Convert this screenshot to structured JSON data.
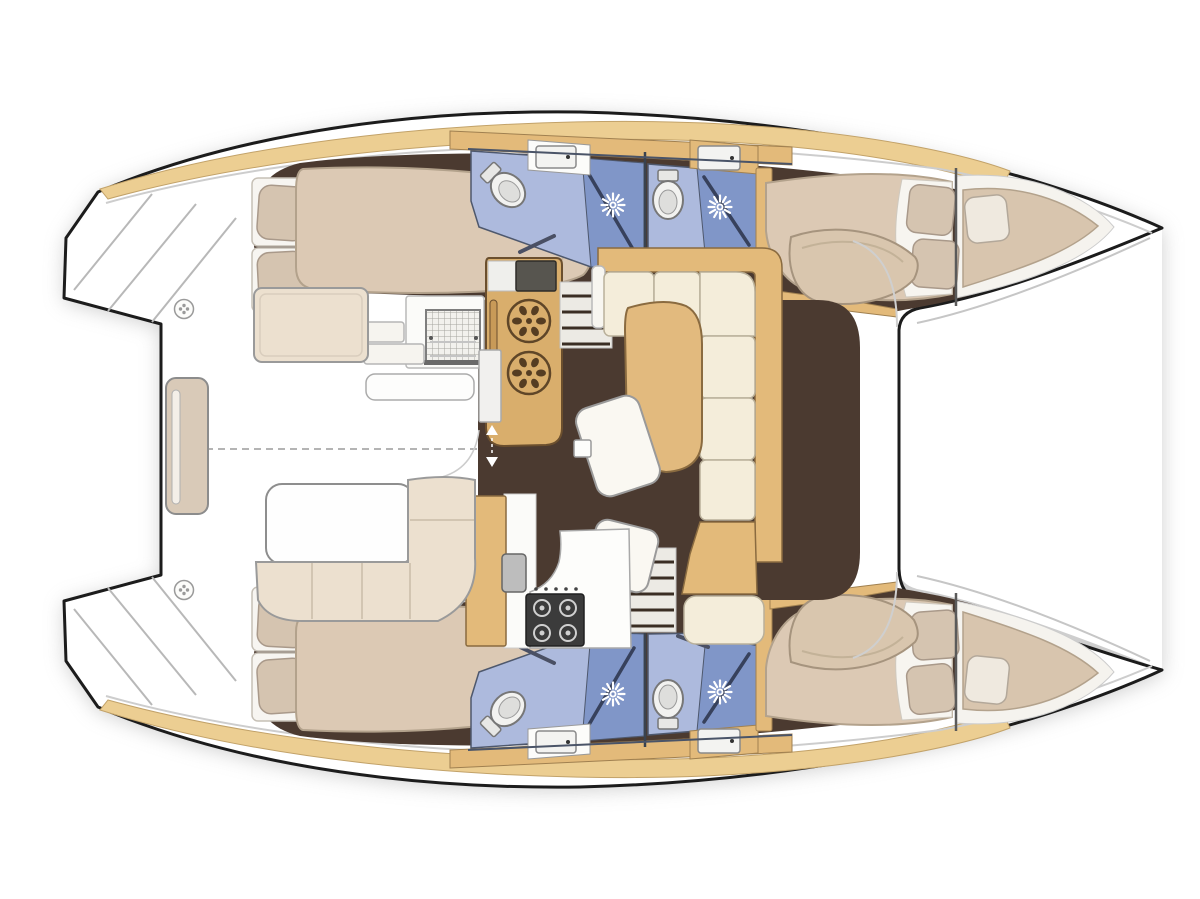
{
  "diagram": {
    "title": "Catamaran yacht floor plan",
    "type": "boat-deck-and-accommodation-layout",
    "view": "top-down",
    "orientation": "bows to the right, sterns with swim steps to the left",
    "hulls": 2,
    "cabins": 4,
    "bathrooms": 4,
    "rooms": {
      "saloon": "Saloon with L-shaped sofa, chart table and chairs",
      "galley_forward": "Forward galley counter with twin round sinks",
      "galley_aft": "Aft galley counter with 4-burner stove",
      "cockpit": "Aft cockpit with table, L-bench and transom bench",
      "foredeck": "Foredeck / trampoline area between the bows",
      "port_hull": "Aft double cabin, bathroom with shower, second shower room, forward double cabin, forepeak berth",
      "starboard_hull": "Aft double cabin, bathroom with shower, second shower room, forward double cabin, forepeak berth"
    },
    "icons": [
      "shower-jet-icon",
      "toilet-icon",
      "round-burner-icon",
      "deck-hatch-icon",
      "mesh-grating-icon",
      "companionway-arrows-icon"
    ]
  },
  "colors": {
    "outline": "#1c1c1c",
    "deck_white": "#ffffff",
    "shadow": "#c2c2c2",
    "floor": "#4b3a30",
    "wood": "#e3ba7a",
    "toe_rail": "#ecce92",
    "counter_wood": "#d9ae6c",
    "mattress": "#dcc9b4",
    "pillow": "#d5c4b0",
    "sofa_cream": "#f4edda",
    "cockpit_bench": "#ece0cf",
    "bath_floor": "#adbadd",
    "shower_blue": "#8096c8",
    "fixture_white": "#f6f6f4"
  }
}
